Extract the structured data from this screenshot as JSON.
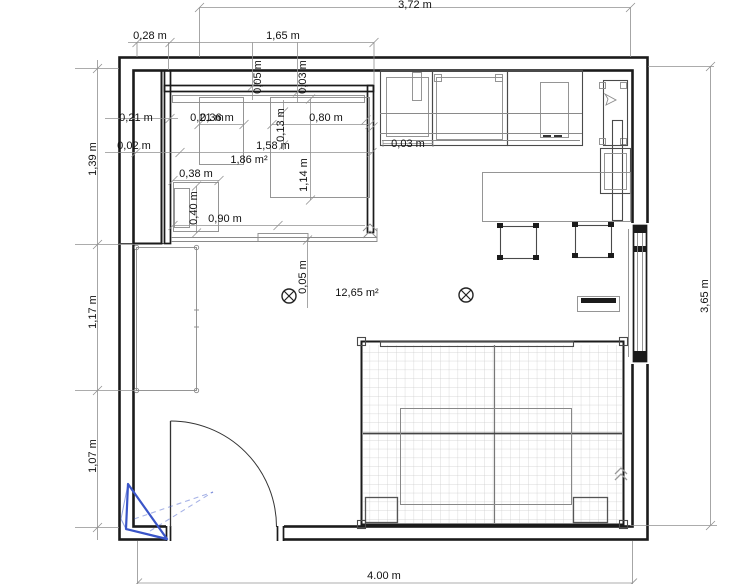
{
  "app": {
    "type": "floor-plan-canvas"
  },
  "colors": {
    "wall": "#1b1b1b",
    "furn": "#4a4a4a",
    "furnlight": "#8a8a8a",
    "dim": "#909090",
    "ink": "#111111",
    "camera": "#3a55c8",
    "grid": "#cbcbcb"
  },
  "areas": {
    "room": "12,65 m²",
    "closet": "1,86 m²"
  },
  "dimensions": {
    "top_total": "3,72 m",
    "top_offset": "0,28 m",
    "closet_width": "1,65 m",
    "top_gap_a": "0,05 m",
    "top_gap_b": "0,03 m",
    "left_column": "0,21 m",
    "cabinet_a": "0,21 m",
    "cabinet_b": "0,36 m",
    "cabinet_c": "0,80 m",
    "cabinet_depth_small": "0,13 m",
    "wall_gap": "0,02 m",
    "closet_inner": "1,58 m",
    "cabinet_depth": "1,14 m",
    "shelf_width": "0,38 m",
    "shelf_depth": "0,40 m",
    "opening": "0,90 m",
    "desk_gap": "0,03 m",
    "mid_gap": "0,05 m",
    "left_top": "1,39 m",
    "left_mid": "1,17 m",
    "left_bottom": "1,07 m",
    "right_total": "3,65 m",
    "bottom_total": "4.00 m"
  }
}
